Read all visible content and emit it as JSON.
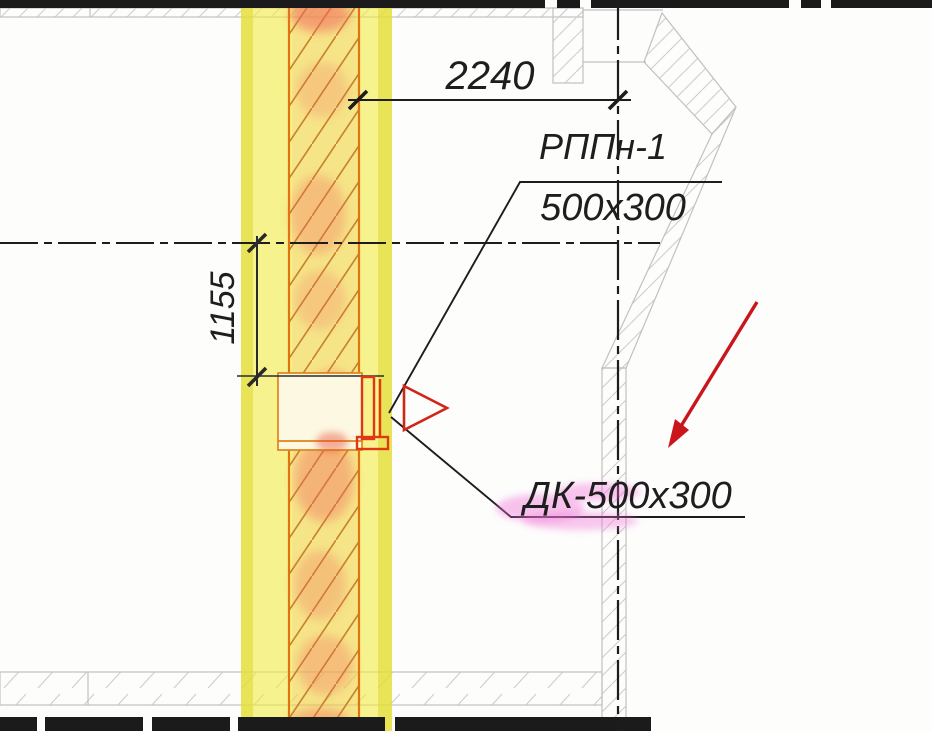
{
  "drawing": {
    "dimensions": {
      "horizontal_offset": "2240",
      "vertical_offset": "1155"
    },
    "callouts": {
      "grille": {
        "name": "РППн-1",
        "size": "500x300"
      },
      "duct": {
        "label": "ДК-500х300"
      }
    },
    "symbols": {
      "air_diffuser": "triangle-right",
      "annotation": "red-arrow"
    },
    "colors": {
      "highlight_yellow": "#f2ea3c",
      "wall_edge_orange": "#e0740e",
      "wall_hatch_orange": "#c28426",
      "duct_red": "#df3914",
      "arrow_red": "#c9151b",
      "pink_marker": "#ef6fd6",
      "ink_black": "#1d1d1d",
      "background_wall_gray": "#c1c1c1"
    }
  }
}
